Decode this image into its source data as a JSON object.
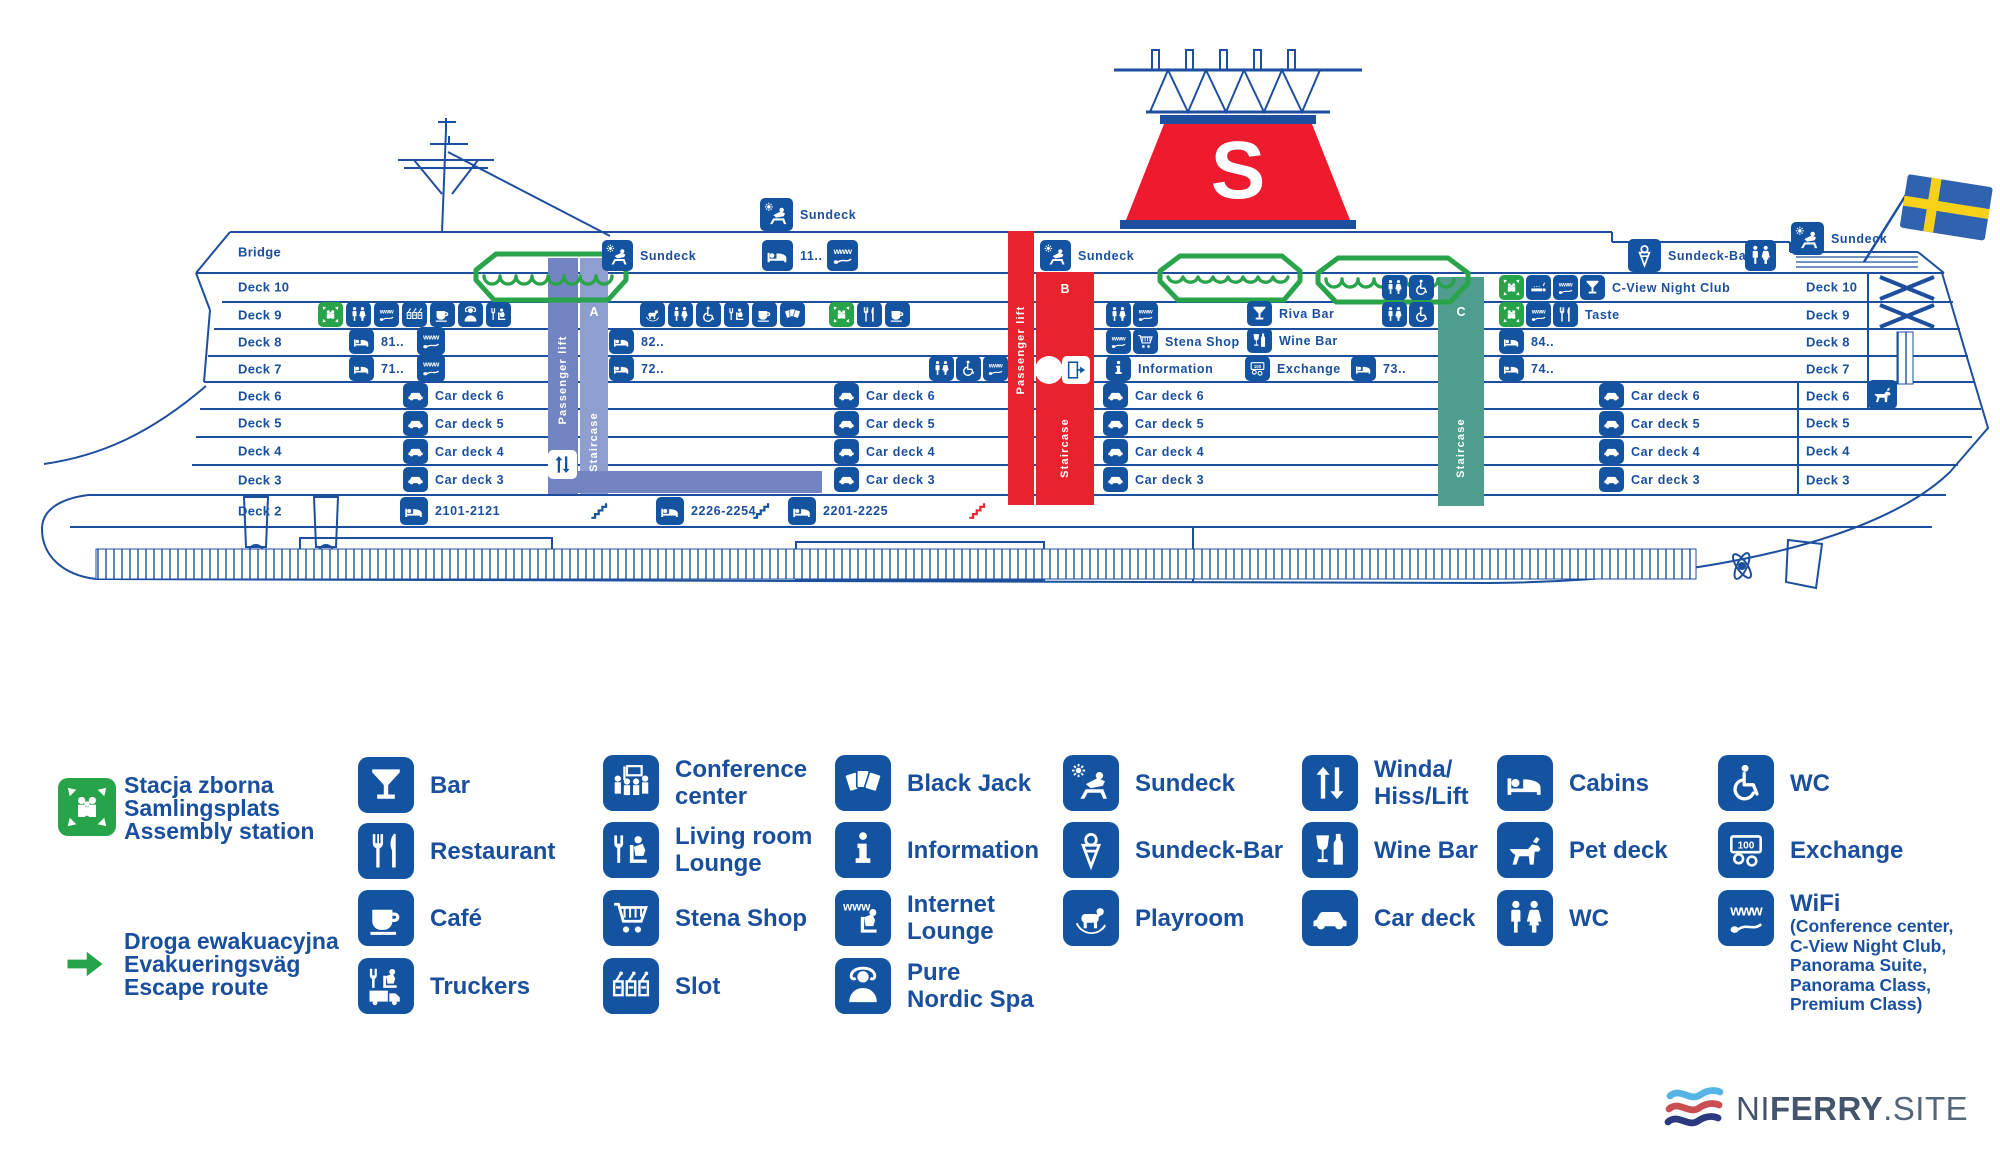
{
  "colors": {
    "primary": "#1a4f9e",
    "icon_blue": "#1453a0",
    "green": "#27a44a",
    "red": "#e8232e",
    "slate": "#7284c1",
    "teal": "#4f9d8d",
    "flag_blue": "#2f63b0",
    "flag_yellow": "#f7d117"
  },
  "ship": {
    "funnel_letter": "S",
    "deck_labels_left": {
      "x": 238,
      "items": [
        {
          "text": "Bridge",
          "y": 252
        },
        {
          "text": "Deck 10",
          "y": 287
        },
        {
          "text": "Deck 9",
          "y": 315
        },
        {
          "text": "Deck 8",
          "y": 342
        },
        {
          "text": "Deck 7",
          "y": 369
        },
        {
          "text": "Deck 6",
          "y": 396
        },
        {
          "text": "Deck 5",
          "y": 423
        },
        {
          "text": "Deck 4",
          "y": 451
        },
        {
          "text": "Deck 3",
          "y": 480
        },
        {
          "text": "Deck 2",
          "y": 511
        }
      ]
    },
    "deck_labels_right": {
      "x": 1806,
      "items": [
        {
          "text": "Deck 10",
          "y": 287
        },
        {
          "text": "Deck 9",
          "y": 315
        },
        {
          "text": "Deck 8",
          "y": 342
        },
        {
          "text": "Deck 7",
          "y": 369
        },
        {
          "text": "Deck 6",
          "y": 396
        },
        {
          "text": "Deck 5",
          "y": 423
        },
        {
          "text": "Deck 4",
          "y": 451
        },
        {
          "text": "Deck 3",
          "y": 480
        }
      ]
    },
    "bands": [
      {
        "name": "staircase-a-lift",
        "x": 548,
        "y": 258,
        "w": 30,
        "h": 236,
        "color": "#7284c1",
        "text": "Passenger lift",
        "text_y": 380
      },
      {
        "name": "staircase-a",
        "x": 580,
        "y": 258,
        "w": 28,
        "h": 236,
        "color": "#8e9ecf",
        "text": "Staircase",
        "text_y": 442,
        "letter": "A",
        "letter_y": 312
      },
      {
        "name": "staircase-a-arm",
        "x": 578,
        "y": 471,
        "w": 244,
        "h": 22,
        "color": "#7284c1"
      },
      {
        "name": "staircase-b-lift",
        "x": 1008,
        "y": 231,
        "w": 26,
        "h": 274,
        "color": "#e8232e",
        "text": "Passenger lift",
        "text_y": 350
      },
      {
        "name": "staircase-b",
        "x": 1036,
        "y": 272,
        "w": 58,
        "h": 233,
        "color": "#e8232e",
        "text": "Staircase",
        "text_y": 448,
        "letter": "B",
        "letter_y": 289
      },
      {
        "name": "staircase-c",
        "x": 1438,
        "y": 277,
        "w": 46,
        "h": 229,
        "color": "#4f9d8d",
        "text": "Staircase",
        "text_y": 448,
        "letter": "C",
        "letter_y": 312
      }
    ],
    "markers": [
      {
        "icon": "sundeck",
        "x": 760,
        "y": 198,
        "s": 33,
        "label": "Sundeck"
      },
      {
        "icon": "sundeck",
        "x": 602,
        "y": 240,
        "s": 31,
        "label": "Sundeck"
      },
      {
        "icon": "cabins",
        "x": 762,
        "y": 240,
        "s": 31,
        "label": "11.."
      },
      {
        "icon": "www",
        "x": 827,
        "y": 240,
        "s": 31
      },
      {
        "icon": "sundeck",
        "x": 1040,
        "y": 240,
        "s": 31,
        "label": "Sundeck"
      },
      {
        "icon": "sundeck-bar",
        "x": 1628,
        "y": 239,
        "s": 33,
        "label": "Sundeck-Bar"
      },
      {
        "icon": "wc",
        "x": 1745,
        "y": 240,
        "s": 31
      },
      {
        "icon": "sundeck",
        "x": 1791,
        "y": 222,
        "s": 33,
        "label": "Sundeck"
      },
      {
        "icon": "wc",
        "x": 1382,
        "y": 275
      },
      {
        "icon": "wc-acc",
        "x": 1409,
        "y": 275
      },
      {
        "icon": "assembly",
        "x": 1499,
        "y": 275,
        "variant": "green"
      },
      {
        "icon": "smoking",
        "x": 1526,
        "y": 275
      },
      {
        "icon": "www",
        "x": 1553,
        "y": 275
      },
      {
        "icon": "bar",
        "x": 1580,
        "y": 275,
        "label": "C-View Night Club"
      },
      {
        "icon": "assembly",
        "x": 318,
        "y": 302,
        "variant": "green"
      },
      {
        "icon": "wc",
        "x": 346,
        "y": 302
      },
      {
        "icon": "www",
        "x": 374,
        "y": 302
      },
      {
        "icon": "slot",
        "x": 402,
        "y": 302
      },
      {
        "icon": "cafe",
        "x": 430,
        "y": 302
      },
      {
        "icon": "spa",
        "x": 458,
        "y": 302
      },
      {
        "icon": "lounge",
        "x": 486,
        "y": 302
      },
      {
        "icon": "playroom",
        "x": 640,
        "y": 302
      },
      {
        "icon": "wc",
        "x": 668,
        "y": 302
      },
      {
        "icon": "wc-acc",
        "x": 696,
        "y": 302
      },
      {
        "icon": "lounge",
        "x": 724,
        "y": 302
      },
      {
        "icon": "cafe",
        "x": 752,
        "y": 302
      },
      {
        "icon": "blackjack",
        "x": 780,
        "y": 302
      },
      {
        "icon": "assembly",
        "x": 829,
        "y": 302,
        "variant": "green"
      },
      {
        "icon": "restaurant",
        "x": 857,
        "y": 302
      },
      {
        "icon": "cafe",
        "x": 885,
        "y": 302
      },
      {
        "icon": "wc",
        "x": 1106,
        "y": 302
      },
      {
        "icon": "www",
        "x": 1133,
        "y": 302
      },
      {
        "icon": "bar",
        "x": 1247,
        "y": 301,
        "label": "Riva Bar"
      },
      {
        "icon": "wc",
        "x": 1382,
        "y": 302
      },
      {
        "icon": "wc-acc",
        "x": 1409,
        "y": 302
      },
      {
        "icon": "assembly",
        "x": 1499,
        "y": 302,
        "variant": "green"
      },
      {
        "icon": "www",
        "x": 1526,
        "y": 302
      },
      {
        "icon": "restaurant",
        "x": 1553,
        "y": 302,
        "label": "Taste"
      },
      {
        "icon": "cabins",
        "x": 349,
        "y": 329,
        "label": "81.."
      },
      {
        "icon": "www",
        "x": 417,
        "y": 327,
        "s": 28
      },
      {
        "icon": "cabins",
        "x": 609,
        "y": 329,
        "label": "82.."
      },
      {
        "icon": "www",
        "x": 1106,
        "y": 329
      },
      {
        "icon": "shop",
        "x": 1133,
        "y": 329,
        "label": "Stena Shop"
      },
      {
        "icon": "wine",
        "x": 1247,
        "y": 328,
        "label": "Wine Bar"
      },
      {
        "icon": "cabins",
        "x": 1499,
        "y": 329,
        "label": "84.."
      },
      {
        "icon": "cabins",
        "x": 349,
        "y": 356,
        "label": "71.."
      },
      {
        "icon": "www",
        "x": 417,
        "y": 354,
        "s": 28
      },
      {
        "icon": "cabins",
        "x": 609,
        "y": 356,
        "label": "72.."
      },
      {
        "icon": "wc",
        "x": 929,
        "y": 356
      },
      {
        "icon": "wc-acc",
        "x": 956,
        "y": 356
      },
      {
        "icon": "www",
        "x": 983,
        "y": 356
      },
      {
        "icon": "info",
        "x": 1106,
        "y": 356,
        "label": "Information"
      },
      {
        "icon": "exchange",
        "x": 1245,
        "y": 356,
        "label": "Exchange"
      },
      {
        "icon": "cabins",
        "x": 1351,
        "y": 356,
        "label": "73.."
      },
      {
        "icon": "cabins",
        "x": 1499,
        "y": 356,
        "label": "74.."
      },
      {
        "icon": "car",
        "x": 403,
        "y": 383,
        "label": "Car deck 6"
      },
      {
        "icon": "car",
        "x": 834,
        "y": 383,
        "label": "Car deck 6"
      },
      {
        "icon": "car",
        "x": 1103,
        "y": 383,
        "label": "Car deck 6"
      },
      {
        "icon": "car",
        "x": 1599,
        "y": 383,
        "label": "Car deck 6"
      },
      {
        "icon": "pet",
        "x": 1868,
        "y": 380,
        "s": 29
      },
      {
        "icon": "car",
        "x": 403,
        "y": 411,
        "label": "Car deck 5"
      },
      {
        "icon": "car",
        "x": 834,
        "y": 411,
        "label": "Car deck 5"
      },
      {
        "icon": "car",
        "x": 1103,
        "y": 411,
        "label": "Car deck 5"
      },
      {
        "icon": "car",
        "x": 1599,
        "y": 411,
        "label": "Car deck 5"
      },
      {
        "icon": "car",
        "x": 403,
        "y": 439,
        "label": "Car deck 4"
      },
      {
        "icon": "car",
        "x": 834,
        "y": 439,
        "label": "Car deck 4"
      },
      {
        "icon": "car",
        "x": 1103,
        "y": 439,
        "label": "Car deck 4"
      },
      {
        "icon": "car",
        "x": 1599,
        "y": 439,
        "label": "Car deck 4"
      },
      {
        "icon": "car",
        "x": 403,
        "y": 467,
        "label": "Car deck 3"
      },
      {
        "icon": "car",
        "x": 834,
        "y": 467,
        "label": "Car deck 3"
      },
      {
        "icon": "car",
        "x": 1103,
        "y": 467,
        "label": "Car deck 3"
      },
      {
        "icon": "car",
        "x": 1599,
        "y": 467,
        "label": "Car deck 3"
      },
      {
        "icon": "cabins",
        "x": 400,
        "y": 497,
        "s": 28,
        "label": "2101-2121"
      },
      {
        "icon": "stairs",
        "x": 586,
        "y": 496,
        "s": 28,
        "variant": "plain"
      },
      {
        "icon": "cabins",
        "x": 656,
        "y": 497,
        "s": 28,
        "label": "2226-2254"
      },
      {
        "icon": "stairs",
        "x": 748,
        "y": 496,
        "s": 28,
        "variant": "plain"
      },
      {
        "icon": "cabins",
        "x": 788,
        "y": 497,
        "s": 28,
        "label": "2201-2225"
      },
      {
        "icon": "stairs",
        "x": 964,
        "y": 496,
        "s": 28,
        "variant": "red"
      },
      {
        "icon": "lift",
        "x": 548,
        "y": 450,
        "s": 29,
        "variant": "white"
      },
      {
        "icon": "dot",
        "x": 1035,
        "y": 356,
        "s": 28,
        "variant": "dot"
      },
      {
        "icon": "door",
        "x": 1062,
        "y": 356,
        "s": 28,
        "variant": "white"
      }
    ]
  },
  "legend": {
    "assembly": {
      "icon_x": 58,
      "icon_y": 778,
      "text_x": 124,
      "text_y": 774,
      "lines": [
        "Stacja zborna",
        "Samlingsplats",
        "Assembly station"
      ]
    },
    "escape": {
      "arrow_x": 64,
      "arrow_y": 950,
      "text_x": 124,
      "text_y": 930,
      "lines": [
        "Droga ewakuacyjna",
        "Evakueringsväg",
        "Escape route"
      ]
    },
    "items": [
      {
        "icon": "bar",
        "x": 358,
        "y": 757,
        "label": [
          "Bar"
        ]
      },
      {
        "icon": "restaurant",
        "x": 358,
        "y": 823,
        "label": [
          "Restaurant"
        ]
      },
      {
        "icon": "cafe",
        "x": 358,
        "y": 890,
        "label": [
          "Café"
        ]
      },
      {
        "icon": "truckers",
        "x": 358,
        "y": 958,
        "label": [
          "Truckers"
        ]
      },
      {
        "icon": "conference",
        "x": 603,
        "y": 755,
        "label": [
          "Conference",
          "center"
        ]
      },
      {
        "icon": "lounge",
        "x": 603,
        "y": 822,
        "label": [
          "Living room",
          "Lounge"
        ]
      },
      {
        "icon": "shop",
        "x": 603,
        "y": 890,
        "label": [
          "Stena Shop"
        ]
      },
      {
        "icon": "slot",
        "x": 603,
        "y": 958,
        "label": [
          "Slot"
        ]
      },
      {
        "icon": "blackjack",
        "x": 835,
        "y": 755,
        "label": [
          "Black Jack"
        ]
      },
      {
        "icon": "info",
        "x": 835,
        "y": 822,
        "label": [
          "Information"
        ]
      },
      {
        "icon": "internet",
        "x": 835,
        "y": 890,
        "label": [
          "Internet",
          "Lounge"
        ]
      },
      {
        "icon": "spa",
        "x": 835,
        "y": 958,
        "label": [
          "Pure",
          "Nordic Spa"
        ]
      },
      {
        "icon": "sundeck",
        "x": 1063,
        "y": 755,
        "label": [
          "Sundeck"
        ]
      },
      {
        "icon": "sundeck-bar",
        "x": 1063,
        "y": 822,
        "label": [
          "Sundeck-Bar"
        ]
      },
      {
        "icon": "playroom",
        "x": 1063,
        "y": 890,
        "label": [
          "Playroom"
        ]
      },
      {
        "icon": "lift",
        "x": 1302,
        "y": 755,
        "label": [
          "Winda/",
          "Hiss/Lift"
        ]
      },
      {
        "icon": "wine",
        "x": 1302,
        "y": 822,
        "label": [
          "Wine Bar"
        ]
      },
      {
        "icon": "car",
        "x": 1302,
        "y": 890,
        "label": [
          "Car deck"
        ]
      },
      {
        "icon": "cabins",
        "x": 1497,
        "y": 755,
        "label": [
          "Cabins"
        ]
      },
      {
        "icon": "pet",
        "x": 1497,
        "y": 822,
        "label": [
          "Pet deck"
        ]
      },
      {
        "icon": "wc",
        "x": 1497,
        "y": 890,
        "label": [
          "WC"
        ]
      },
      {
        "icon": "wc-acc",
        "x": 1718,
        "y": 755,
        "label": [
          "WC"
        ]
      },
      {
        "icon": "exchange",
        "x": 1718,
        "y": 822,
        "label": [
          "Exchange"
        ]
      },
      {
        "icon": "wifi",
        "x": 1718,
        "y": 890,
        "label": [
          "WiFi"
        ],
        "sub": [
          "(Conference center,",
          "C-View Night Club,",
          "Panorama Suite,",
          "Panorama Class,",
          "Premium Class)"
        ]
      }
    ]
  },
  "branding": {
    "pre": "NI",
    "bold": "FERRY",
    "suf": ".SITE"
  }
}
